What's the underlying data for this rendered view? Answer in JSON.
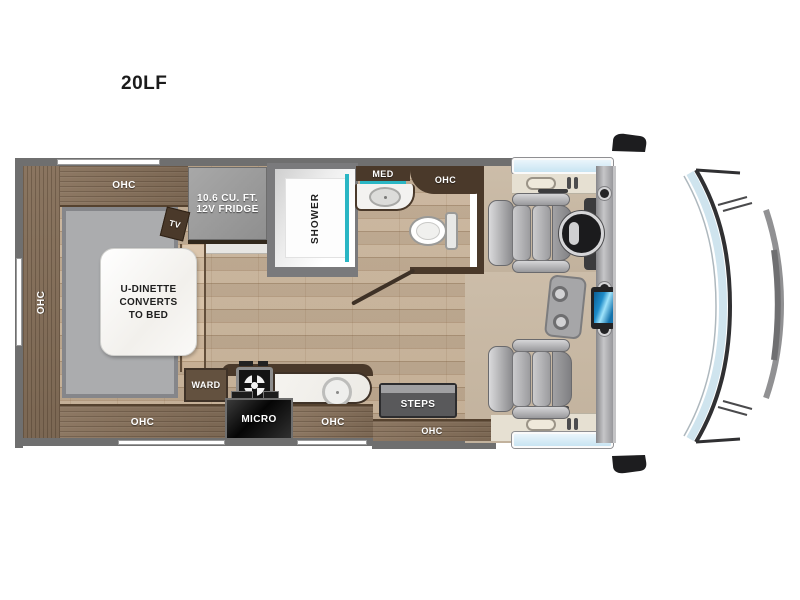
{
  "title": "20LF",
  "labels": {
    "ohc": "OHC",
    "tv": "TV",
    "step": "STEP",
    "shower": "SHOWER",
    "med": "MED",
    "ward": "WARD",
    "micro": "MICRO",
    "steps": "STEPS",
    "fridge": [
      "10.6 CU. FT.",
      "12V FRIDGE"
    ],
    "dinette": [
      "U-DINETTE",
      "CONVERTS",
      "TO BED"
    ]
  },
  "colors": {
    "accent_teal": "#2ab6c4",
    "wall_gray": "#6f6f6f",
    "cabinet_wood": "#84705c",
    "dark_walnut": "#4a392a",
    "floor_wood": "#c9b49b",
    "cab_floor_tan": "#c9baa7",
    "window_blue": "#d2e8f3",
    "screen_blue": "#1f8cc9",
    "seat_gray": "#a9a9ab"
  }
}
